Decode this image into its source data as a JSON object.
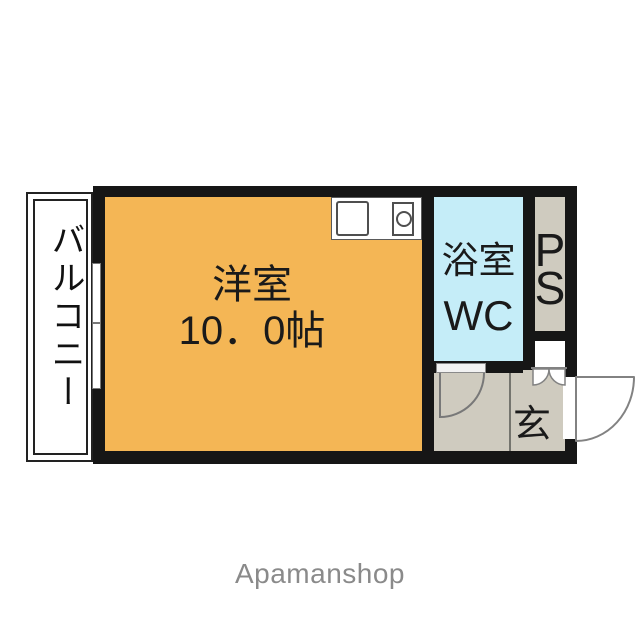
{
  "floorplan": {
    "rooms": {
      "main_room": {
        "name": "洋室",
        "size": "10．0帖"
      },
      "bathroom": {
        "line1": "浴室",
        "line2": "WC"
      },
      "pipe_space": {
        "line1": "P",
        "line2": "S"
      },
      "entrance": {
        "label": "玄"
      },
      "balcony": {
        "label": "バルコニー"
      }
    },
    "colors": {
      "main_room": "#F4B655",
      "bathroom": "#C5EDF8",
      "service_floor": "#CFCBBF",
      "wall": "#161616",
      "door_outline": "#828282"
    }
  },
  "watermark": {
    "brand": "Apamanshop"
  }
}
